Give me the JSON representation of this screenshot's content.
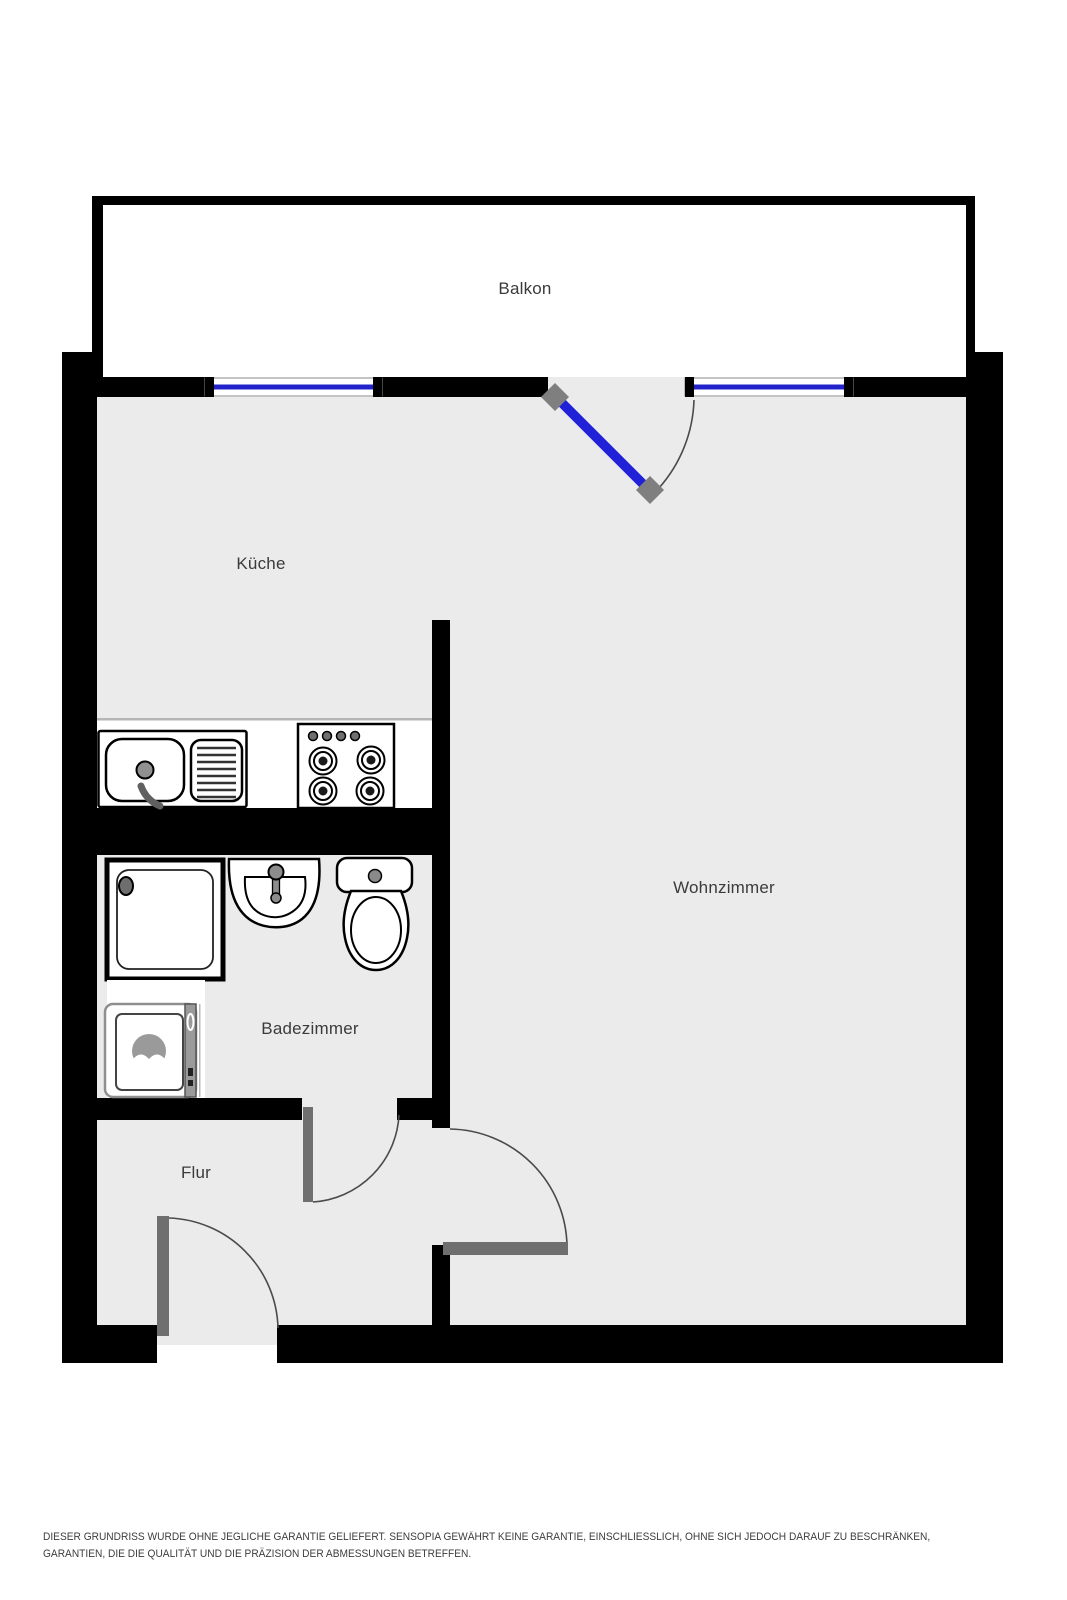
{
  "floorplan": {
    "rooms": [
      {
        "id": "balkon",
        "label": "Balkon"
      },
      {
        "id": "kueche",
        "label": "Küche"
      },
      {
        "id": "wohnzimmer",
        "label": "Wohnzimmer"
      },
      {
        "id": "badezimmer",
        "label": "Badezimmer"
      },
      {
        "id": "flur",
        "label": "Flur"
      }
    ],
    "fixtures": [
      "kitchen-sink-with-drainboard",
      "stove-4-burner",
      "shower-tray",
      "washbasin",
      "toilet",
      "washing-machine"
    ],
    "doors": [
      "balcony-door",
      "bathroom-door",
      "living-room-door",
      "entry-door"
    ],
    "windows_count": 2,
    "colors": {
      "wall": "#000000",
      "floor_interior": "#ebebeb",
      "floor_balcony": "#ffffff",
      "window_glass": "#2323cc",
      "balcony_door_leaf": "#2121d8",
      "interior_door_leaf": "#6f6f6f",
      "door_hinge": "#7f7f7f",
      "swing_arc": "#4a4a4a",
      "label_text": "#3b3b3b"
    },
    "disclaimer": "DIESER GRUNDRISS WURDE OHNE JEGLICHE GARANTIE GELIEFERT. SENSOPIA GEWÄHRT KEINE GARANTIE, EINSCHLIESSLICH, OHNE SICH JEDOCH DARAUF ZU BESCHRÄNKEN, GARANTIEN, DIE DIE QUALITÄT UND DIE PRÄZISION DER ABMESSUNGEN BETREFFEN."
  }
}
